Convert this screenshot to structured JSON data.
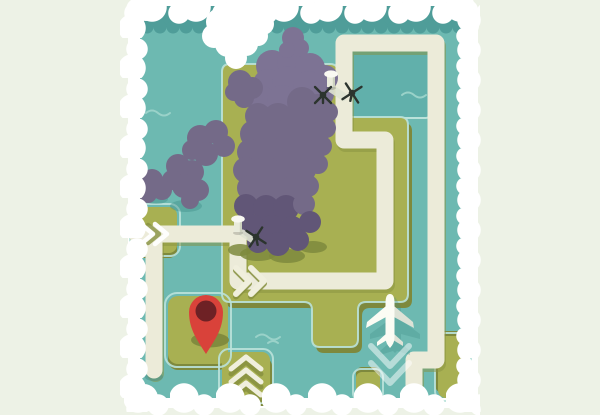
{
  "scene": {
    "type": "illustrated-map",
    "description": "Stylized top-down cartoon map: teal water, olive-green islands, purple forest, white looping roads, red destination pin, white airplane, helicopters and control towers, fluffy white cloud border",
    "features": [
      "water",
      "lagoon",
      "forest",
      "roads",
      "direction-chevrons",
      "location-pin",
      "airplane",
      "helicopters",
      "control-towers",
      "islands",
      "cloud-border",
      "wave-marks"
    ]
  },
  "markers": {
    "pin": {
      "label": "destination-pin"
    },
    "plane": {
      "label": "airplane"
    },
    "helicopters": {
      "count": 3
    },
    "towers": {
      "count": 2
    }
  },
  "colors": {
    "bg": "#edf2e6",
    "frame": "#ffffff",
    "water": "#6db9b1",
    "water-dark": "#4f9d99",
    "lagoon": "#61b0ab",
    "wave": "#9ad2c9",
    "shore": "#bae2da",
    "land": "#a8b052",
    "land-shade": "#7e893d",
    "road": "#ecebd9",
    "road-shadow": "#87913f",
    "cream": "#f0efdd",
    "forest": "#746a88",
    "forest-dark": "#615677",
    "forest-light": "#7d7394",
    "heli": "#2c342e",
    "pin": "#d9423a",
    "pin-dark": "#6e2125",
    "plane": "#fbfcf4",
    "plane-shade": "#dde2d6",
    "shadow-teal": "#3e8d86"
  }
}
